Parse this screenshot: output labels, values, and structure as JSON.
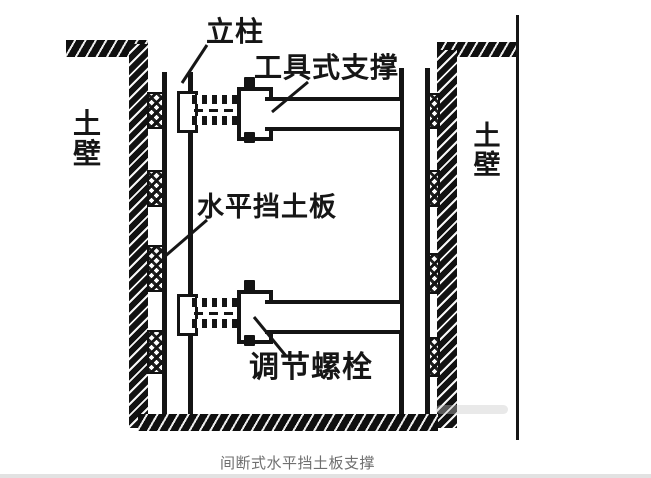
{
  "diagram": {
    "caption": "间断式水平挡土板支撑",
    "labels": {
      "column": "立柱",
      "tool_strut": "工具式支撑",
      "soil_wall_left": "土壁",
      "soil_wall_right": "土壁",
      "horizontal_board": "水平挡土板",
      "adjust_bolt": "调节螺栓"
    },
    "colors": {
      "ink": "#161616",
      "caption_text": "#6f6f6f",
      "background": "#ffffff"
    }
  }
}
